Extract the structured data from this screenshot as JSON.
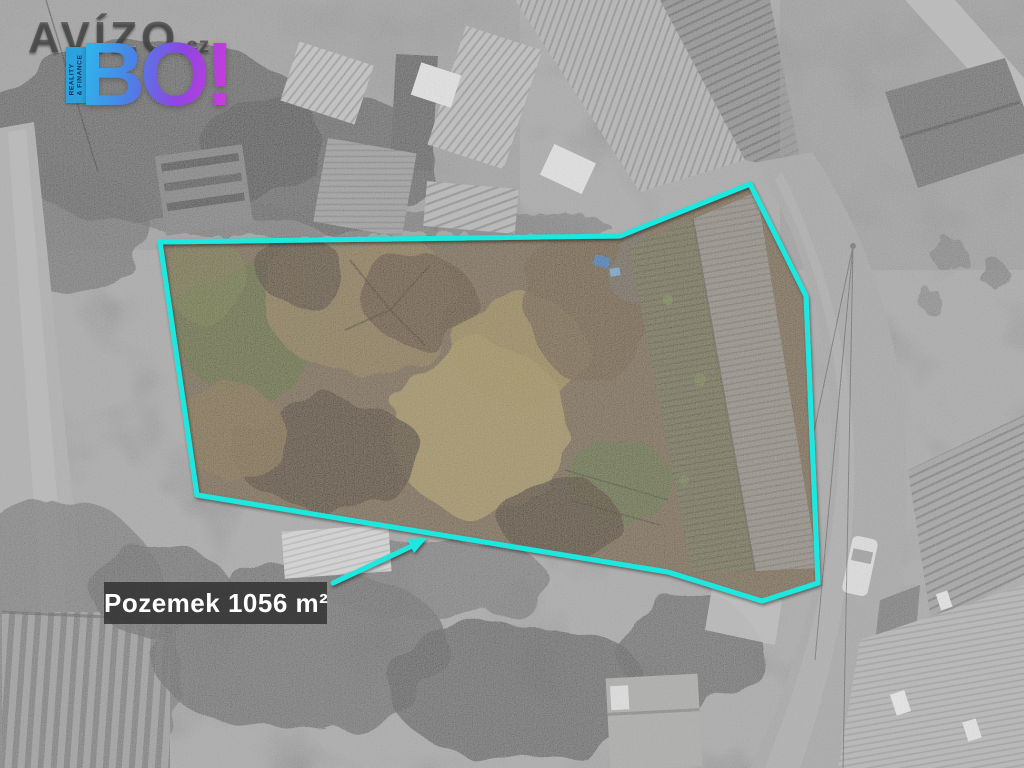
{
  "logo": {
    "brand": "AVÍZO",
    "tld": ".cz",
    "badge": "BO!",
    "ribbon_line1": "REALITY",
    "ribbon_line2": "& FINANCE"
  },
  "parcel": {
    "label": "Pozemek 1056 m²"
  },
  "colors": {
    "boundary": "#1DE8E0",
    "label_bg": "rgba(44,44,44,0.8)",
    "label_text": "#FFFFFF",
    "bo_gradient_start": "#2FB6EA",
    "bo_gradient_end": "#C93BDC",
    "ribbon_bg": "#2BA2DE"
  }
}
